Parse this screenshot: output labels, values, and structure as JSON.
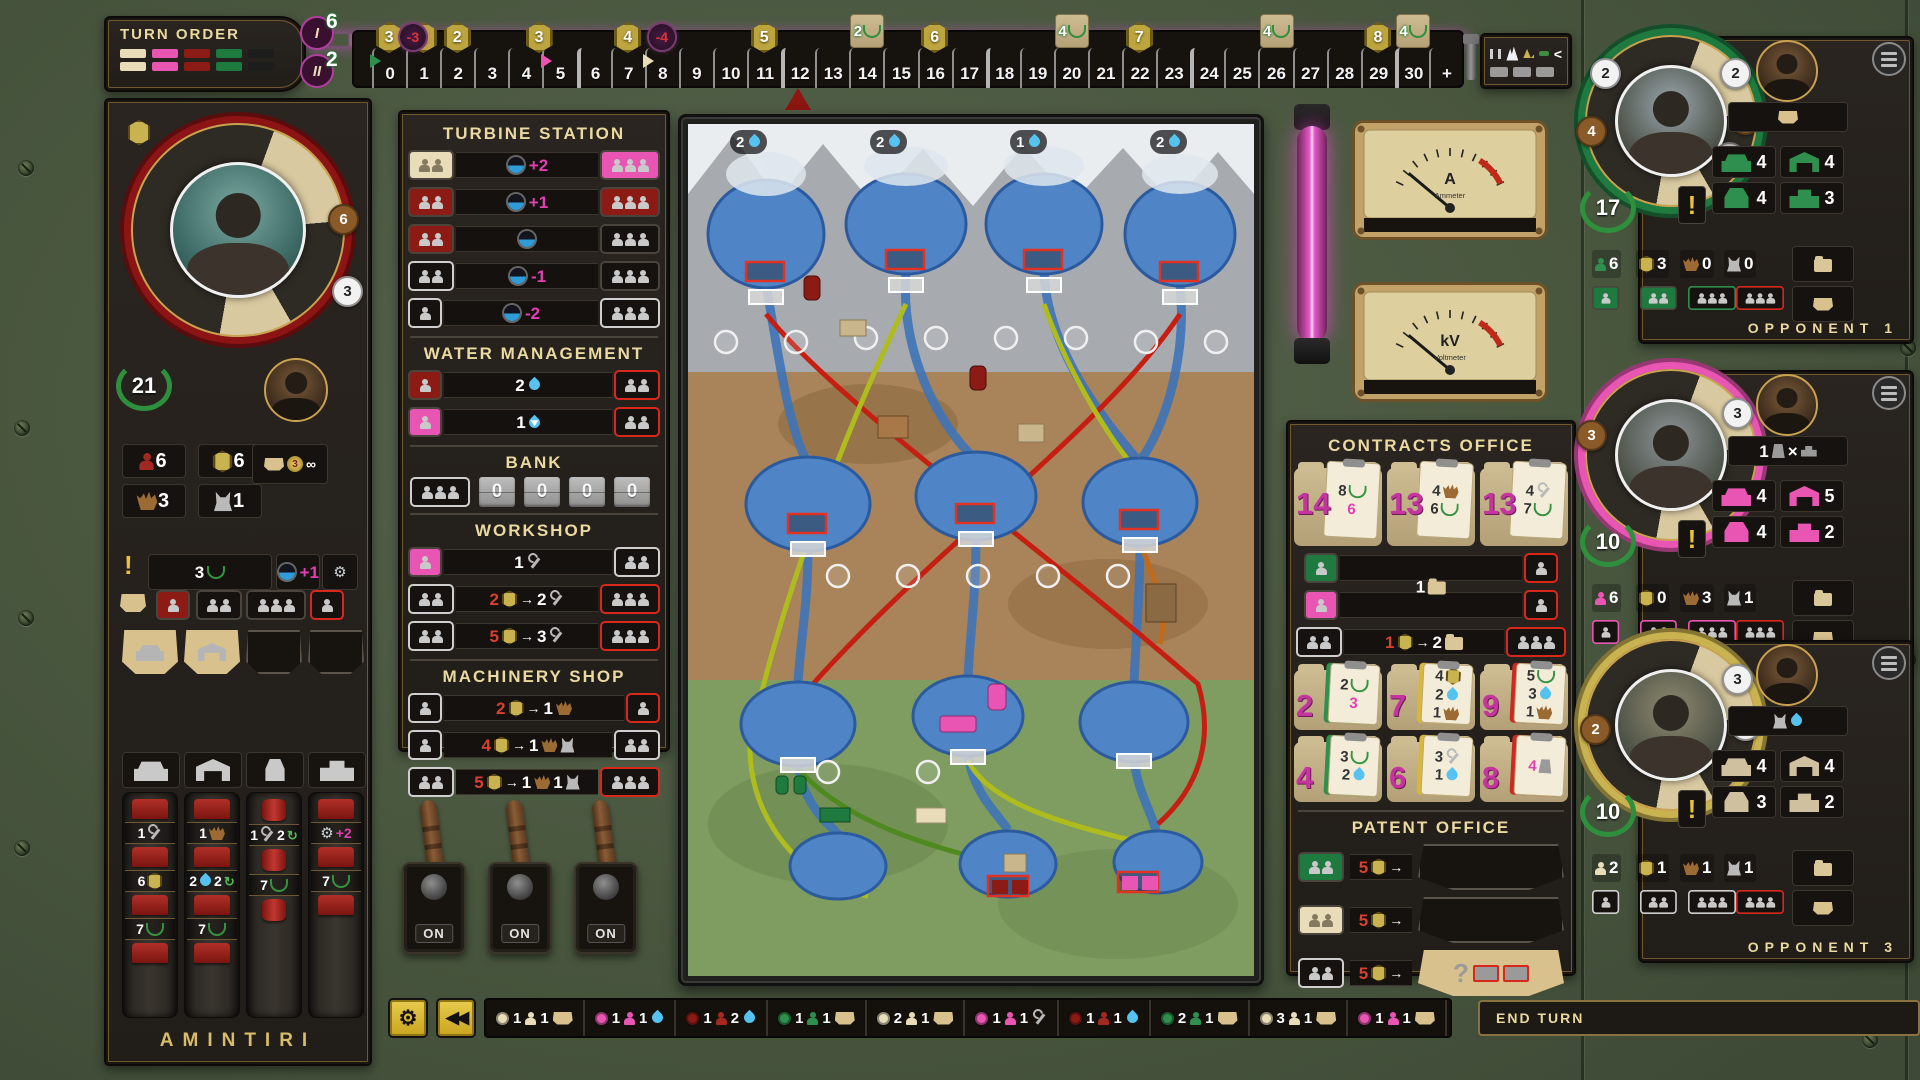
{
  "turn_order": {
    "title": "TURN ORDER",
    "tokens": [
      "cream",
      "pink",
      "darkred",
      "green",
      "black"
    ]
  },
  "round_markers": [
    {
      "numeral": "I",
      "value": "6"
    },
    {
      "numeral": "II",
      "value": "2"
    }
  ],
  "energy_track": {
    "cells": [
      "0",
      "1",
      "2",
      "3",
      "4",
      "5",
      "6",
      "7",
      "8",
      "9",
      "10",
      "11",
      "12",
      "13",
      "14",
      "15",
      "16",
      "17",
      "18",
      "19",
      "20",
      "21",
      "22",
      "23",
      "24",
      "25",
      "26",
      "27",
      "28",
      "29",
      "30",
      "+"
    ],
    "hex_badges": [
      {
        "cell": 0,
        "value": "3"
      },
      {
        "cell": 1,
        "value": "1"
      },
      {
        "cell": 2,
        "value": "2"
      },
      {
        "cell": 4.4,
        "value": "3"
      },
      {
        "cell": 7,
        "value": "4"
      },
      {
        "cell": 11,
        "value": "5"
      },
      {
        "cell": 16,
        "value": "6"
      },
      {
        "cell": 22,
        "value": "7"
      },
      {
        "cell": 29,
        "value": "8"
      }
    ],
    "penalty_badges": [
      {
        "cell": 0.7,
        "value": "-3"
      },
      {
        "cell": 8,
        "value": "-4"
      }
    ],
    "tile_badges": [
      {
        "cell": 14,
        "value": "2"
      },
      {
        "cell": 20,
        "value": "4"
      },
      {
        "cell": 26,
        "value": "4"
      },
      {
        "cell": 30,
        "value": "4"
      }
    ],
    "player_markers": [
      {
        "cell": 0,
        "color": "#2f8f4e"
      },
      {
        "cell": 5,
        "color": "#e855b3"
      },
      {
        "cell": 8,
        "color": "#e9ddb9"
      },
      {
        "cell": 12,
        "color": "#8c1610"
      }
    ]
  },
  "forecast": {
    "symbol": "<"
  },
  "player": {
    "name": "AMINTIRI",
    "vp": "21",
    "wheel_badges": [
      {
        "value": "6",
        "style": "brown",
        "x": 208,
        "y": 92
      },
      {
        "value": "3",
        "style": "white",
        "x": 212,
        "y": 164
      }
    ],
    "resources": [
      {
        "icon": "engineer",
        "value": "6"
      },
      {
        "icon": "credits",
        "value": "6"
      },
      {
        "icon": "excavator",
        "value": "3"
      },
      {
        "icon": "mixer",
        "value": "1"
      }
    ],
    "income": {
      "medal": "3",
      "infinity": "∞"
    },
    "objective": {
      "value": "3"
    },
    "bonus_chips": [
      {
        "tokens": [
          "Iturbine",
          "m+1"
        ]
      },
      {
        "tokens": [
          "Igear"
        ]
      }
    ],
    "worker_slots": [
      {
        "m": 1,
        "style": "red"
      },
      {
        "m": 2,
        "style": "dark"
      },
      {
        "m": 3,
        "style": "dark"
      },
      {
        "m": 1,
        "style": "dark red-border"
      }
    ],
    "wheel_segments": [
      {
        "type": "base",
        "filled": true
      },
      {
        "type": "elevation",
        "filled": true
      },
      {
        "type": "conduit",
        "filled": false
      },
      {
        "type": "powerhouse",
        "filled": false
      }
    ],
    "build_columns": [
      {
        "type": "base",
        "costs": [
          [
            "w1",
            "Iwrench"
          ],
          [
            "w6",
            "Ihex"
          ],
          [
            "w7",
            "Ilaurel"
          ]
        ]
      },
      {
        "type": "elevation",
        "costs": [
          [
            "w1",
            "Iexcavator"
          ],
          [
            "w2",
            "Idrop",
            "w2",
            "Irecycle"
          ],
          [
            "w7",
            "Ilaurel"
          ]
        ]
      },
      {
        "type": "conduit",
        "costs": [
          [
            "w1",
            "Iwrench",
            "w2",
            "Irecycle"
          ],
          [
            "w7",
            "Ilaurel"
          ]
        ]
      },
      {
        "type": "powerhouse",
        "costs": [
          [
            "Igear",
            "m+2"
          ],
          [
            "w7",
            "Ilaurel"
          ]
        ]
      }
    ]
  },
  "turbine_station": {
    "title": "TURBINE STATION",
    "rows": [
      {
        "left": {
          "m": 2,
          "style": "cream"
        },
        "tokens": [
          "Iturbine",
          "m+2"
        ],
        "right": {
          "m": 3,
          "style": "pink"
        }
      },
      {
        "left": {
          "m": 2,
          "style": "red"
        },
        "tokens": [
          "Iturbine",
          "m+1"
        ],
        "right": {
          "m": 3,
          "style": "red"
        }
      },
      {
        "left": {
          "m": 2,
          "style": "red"
        },
        "tokens": [
          "Iturbine"
        ],
        "right": {
          "m": 3,
          "style": "dark"
        }
      },
      {
        "left": {
          "m": 2,
          "style": "dark white-border"
        },
        "tokens": [
          "Iturbine",
          "m-1"
        ],
        "right": {
          "m": 3,
          "style": "dark"
        }
      },
      {
        "left": {
          "m": 1,
          "style": "dark white-border"
        },
        "tokens": [
          "Iturbine",
          "m-2"
        ],
        "right": {
          "m": 3,
          "style": "dark white-border"
        }
      }
    ]
  },
  "water_management": {
    "title": "WATER MANAGEMENT",
    "rows": [
      {
        "left": {
          "m": 1,
          "style": "red"
        },
        "tokens": [
          "w2",
          "Idrop"
        ],
        "right": {
          "m": 2,
          "style": "dark red-border"
        }
      },
      {
        "left": {
          "m": 1,
          "style": "pink"
        },
        "tokens": [
          "w1",
          "Idropdown"
        ],
        "right": {
          "m": 2,
          "style": "dark red-border"
        }
      }
    ]
  },
  "bank": {
    "title": "BANK",
    "counters": [
      "0",
      "0",
      "0",
      "0"
    ]
  },
  "workshop": {
    "title": "WORKSHOP",
    "rows": [
      {
        "left": {
          "m": 1,
          "style": "pink"
        },
        "tokens": [
          "w1",
          "Iwrench"
        ],
        "right": {
          "m": 2,
          "style": "dark white-border"
        }
      },
      {
        "left": {
          "m": 2,
          "style": "dark white-border"
        },
        "tokens": [
          "r2",
          "Ihex",
          "Iarrow",
          "w2",
          "Iwrench"
        ],
        "right": {
          "m": 3,
          "style": "dark red-border"
        }
      },
      {
        "left": {
          "m": 2,
          "style": "dark white-border"
        },
        "tokens": [
          "r5",
          "Ihex",
          "Iarrow",
          "w3",
          "Iwrench"
        ],
        "right": {
          "m": 3,
          "style": "dark red-border"
        }
      }
    ]
  },
  "machinery_shop": {
    "title": "MACHINERY SHOP",
    "rows": [
      {
        "left": {
          "m": 1,
          "style": "dark white-border"
        },
        "tokens": [
          "r2",
          "Ihex",
          "Iarrow",
          "w1",
          "Iexcavator"
        ],
        "right": {
          "m": 1,
          "style": "dark red-border"
        }
      },
      {
        "left": {
          "m": 1,
          "style": "dark white-border"
        },
        "tokens": [
          "r4",
          "Ihex",
          "Iarrow",
          "w1",
          "Iexcavator",
          "Imixer"
        ],
        "right": {
          "m": 2,
          "style": "dark white-border"
        }
      },
      {
        "left": {
          "m": 2,
          "style": "dark white-border"
        },
        "tokens": [
          "r5",
          "Ihex",
          "Iarrow",
          "w1",
          "Iexcavator",
          "w1",
          "Imixer"
        ],
        "right": {
          "m": 3,
          "style": "dark red-border"
        }
      }
    ]
  },
  "switches": {
    "labels": [
      "ON",
      "ON",
      "ON"
    ]
  },
  "map": {
    "water_badges": [
      "2",
      "2",
      "1",
      "2"
    ]
  },
  "gauges": [
    {
      "unit": "A",
      "label": "Ammeter"
    },
    {
      "unit": "kV",
      "label": "Voltmeter"
    }
  ],
  "contracts_office": {
    "title": "CONTRACTS OFFICE",
    "top_contracts": [
      {
        "value": "14",
        "rewards": [
          [
            "w8",
            "Ilaurel"
          ],
          [
            "m6"
          ]
        ]
      },
      {
        "value": "13",
        "rewards": [
          [
            "w4",
            "Iexcavator"
          ],
          [
            "w6",
            "Ilaurel"
          ]
        ]
      },
      {
        "value": "13",
        "rewards": [
          [
            "w4",
            "Iwrench"
          ],
          [
            "w7",
            "Ilaurel"
          ]
        ]
      }
    ],
    "pick_slots": [
      {
        "left": {
          "m": 1,
          "style": "green"
        },
        "right": {
          "m": 1,
          "style": "dark red-border"
        }
      },
      {
        "left": {
          "m": 1,
          "style": "pink"
        },
        "right": {
          "m": 1,
          "style": "dark red-border"
        }
      }
    ],
    "pick_label": [
      "w1",
      "Ifolder"
    ],
    "exchange_row": {
      "left": {
        "m": 2,
        "style": "dark white-border"
      },
      "tokens": [
        "r1",
        "Ihex",
        "Iarrow",
        "w2",
        "Ifolder"
      ],
      "right": {
        "m": 3,
        "style": "dark red-border"
      }
    },
    "market": [
      {
        "value": "2",
        "clip": "green",
        "rewards": [
          [
            "w2",
            "Ilaurel"
          ],
          [
            "m3"
          ]
        ]
      },
      {
        "value": "7",
        "clip": "yellow",
        "rewards": [
          [
            "w4",
            "Ihex"
          ],
          [
            "w2",
            "Idrop"
          ],
          [
            "w1",
            "Iexcavator"
          ]
        ]
      },
      {
        "value": "9",
        "clip": "red",
        "rewards": [
          [
            "w5",
            "Ilaurel"
          ],
          [
            "w3",
            "Idrop"
          ],
          [
            "w1",
            "Iexcavator"
          ]
        ]
      },
      {
        "value": "4",
        "clip": "green",
        "rewards": [
          [
            "w3",
            "Ilaurel"
          ],
          [
            "w2",
            "Idrop"
          ]
        ]
      },
      {
        "value": "6",
        "clip": "yellow",
        "rewards": [
          [
            "w3",
            "Iwrench"
          ],
          [
            "w1",
            "Idrop"
          ]
        ]
      },
      {
        "value": "8",
        "clip": "red",
        "rewards": [
          [
            "m4",
            "Iconduit"
          ]
        ]
      }
    ]
  },
  "patent_office": {
    "title": "PATENT OFFICE",
    "rows": [
      {
        "slot": {
          "m": 2,
          "style": "green"
        },
        "tokens": [
          "r5",
          "Ihex",
          "Iarrow"
        ],
        "segment": "empty"
      },
      {
        "slot": {
          "m": 2,
          "style": "cream"
        },
        "tokens": [
          "r5",
          "Ihex",
          "Iarrow"
        ],
        "segment": "empty"
      },
      {
        "slot": {
          "m": 2,
          "style": "dark white-border"
        },
        "tokens": [
          "r5",
          "Ihex",
          "Iarrow"
        ],
        "segment": "mystery"
      }
    ]
  },
  "opponents": [
    {
      "label": "OPPONENT 1",
      "color_key": "green",
      "vp": "17",
      "wheel_badges": [
        {
          "value": "2",
          "style": "white",
          "x": 16,
          "y": 34
        },
        {
          "value": "4",
          "style": "brown",
          "x": 2,
          "y": 92
        },
        {
          "value": "2",
          "style": "white",
          "x": 146,
          "y": 34
        },
        {
          "value": "2",
          "style": "brown",
          "x": 156,
          "y": 80
        },
        {
          "value": "1",
          "style": "gray",
          "x": 140,
          "y": 118
        }
      ],
      "trait_tokens": [
        "Isegment"
      ],
      "buildings": [
        {
          "type": "base",
          "count": "4"
        },
        {
          "type": "elevation",
          "count": "4"
        },
        {
          "type": "conduit",
          "count": "4"
        },
        {
          "type": "powerhouse",
          "count": "3"
        }
      ],
      "resources": [
        {
          "icon": "engineer",
          "value": "6"
        },
        {
          "icon": "credits",
          "value": "3"
        },
        {
          "icon": "excavator",
          "value": "0"
        },
        {
          "icon": "mixer",
          "value": "0"
        }
      ],
      "worker_slots": [
        {
          "m": 1,
          "style": "green"
        },
        {
          "m": 2,
          "style": "green"
        },
        {
          "m": 3,
          "style": "dark green-border"
        },
        {
          "m": 3,
          "style": "dark red-border"
        }
      ]
    },
    {
      "label": "OPPONENT 2",
      "color_key": "pink",
      "vp": "10",
      "wheel_badges": [
        {
          "value": "3",
          "style": "brown",
          "x": 2,
          "y": 62
        },
        {
          "value": "3",
          "style": "white",
          "x": 148,
          "y": 40
        }
      ],
      "trait_tokens": [
        "w1",
        "Iconduit",
        "w×",
        "Ipowerhouse"
      ],
      "buildings": [
        {
          "type": "base",
          "count": "4"
        },
        {
          "type": "elevation",
          "count": "5"
        },
        {
          "type": "conduit",
          "count": "4"
        },
        {
          "type": "powerhouse",
          "count": "2"
        }
      ],
      "resources": [
        {
          "icon": "engineer",
          "value": "6"
        },
        {
          "icon": "credits",
          "value": "0"
        },
        {
          "icon": "excavator",
          "value": "3"
        },
        {
          "icon": "mixer",
          "value": "1"
        }
      ],
      "worker_slots": [
        {
          "m": 1,
          "style": "dark pink-border"
        },
        {
          "m": 2,
          "style": "dark pink-border"
        },
        {
          "m": 3,
          "style": "dark pink-border"
        },
        {
          "m": 3,
          "style": "dark red-border"
        }
      ]
    },
    {
      "label": "OPPONENT 3",
      "color_key": "tan",
      "vp": "10",
      "wheel_badges": [
        {
          "value": "2",
          "style": "brown",
          "x": 6,
          "y": 86
        },
        {
          "value": "3",
          "style": "white",
          "x": 148,
          "y": 36
        },
        {
          "value": "3",
          "style": "white",
          "x": 156,
          "y": 82
        }
      ],
      "trait_tokens": [
        "Imixer",
        "Idrop"
      ],
      "buildings": [
        {
          "type": "base",
          "count": "4"
        },
        {
          "type": "elevation",
          "count": "4"
        },
        {
          "type": "conduit",
          "count": "3"
        },
        {
          "type": "powerhouse",
          "count": "2"
        }
      ],
      "resources": [
        {
          "icon": "engineer",
          "value": "2"
        },
        {
          "icon": "credits",
          "value": "1"
        },
        {
          "icon": "excavator",
          "value": "1"
        },
        {
          "icon": "mixer",
          "value": "1"
        }
      ],
      "worker_slots": [
        {
          "m": 1,
          "style": "dark white-border"
        },
        {
          "m": 2,
          "style": "dark white-border"
        },
        {
          "m": 3,
          "style": "dark white-border"
        },
        {
          "m": 3,
          "style": "dark red-border"
        }
      ]
    }
  ],
  "action_log": {
    "entries": [
      {
        "dot": "#e9ddb9",
        "tokens": [
          "w1",
          "Imeeple-cream",
          "w1",
          "Isegment"
        ]
      },
      {
        "dot": "#e855b3",
        "tokens": [
          "w1",
          "Imeeple-pink",
          "w1",
          "Idrop"
        ]
      },
      {
        "dot": "#8c1b15",
        "tokens": [
          "w1",
          "Imeeple-red",
          "w2",
          "Idrop"
        ]
      },
      {
        "dot": "#2f8f4e",
        "tokens": [
          "w1",
          "Imeeple-green",
          "w1",
          "Isegment"
        ]
      },
      {
        "dot": "#e9ddb9",
        "tokens": [
          "w2",
          "Imeeple-cream",
          "w1",
          "Isegment"
        ]
      },
      {
        "dot": "#e855b3",
        "tokens": [
          "w1",
          "Imeeple-pink",
          "w1",
          "Iwrench"
        ]
      },
      {
        "dot": "#8c1b15",
        "tokens": [
          "w1",
          "Imeeple-red",
          "w1",
          "Idrop"
        ]
      },
      {
        "dot": "#2f8f4e",
        "tokens": [
          "w2",
          "Imeeple-green",
          "w1",
          "Isegment"
        ]
      },
      {
        "dot": "#e9ddb9",
        "tokens": [
          "w3",
          "Imeeple-cream",
          "w1",
          "Isegment"
        ]
      },
      {
        "dot": "#e855b3",
        "tokens": [
          "w1",
          "Imeeple-pink",
          "w1",
          "Isegment"
        ]
      }
    ]
  },
  "toolbar": {
    "end_turn": "END TURN"
  }
}
